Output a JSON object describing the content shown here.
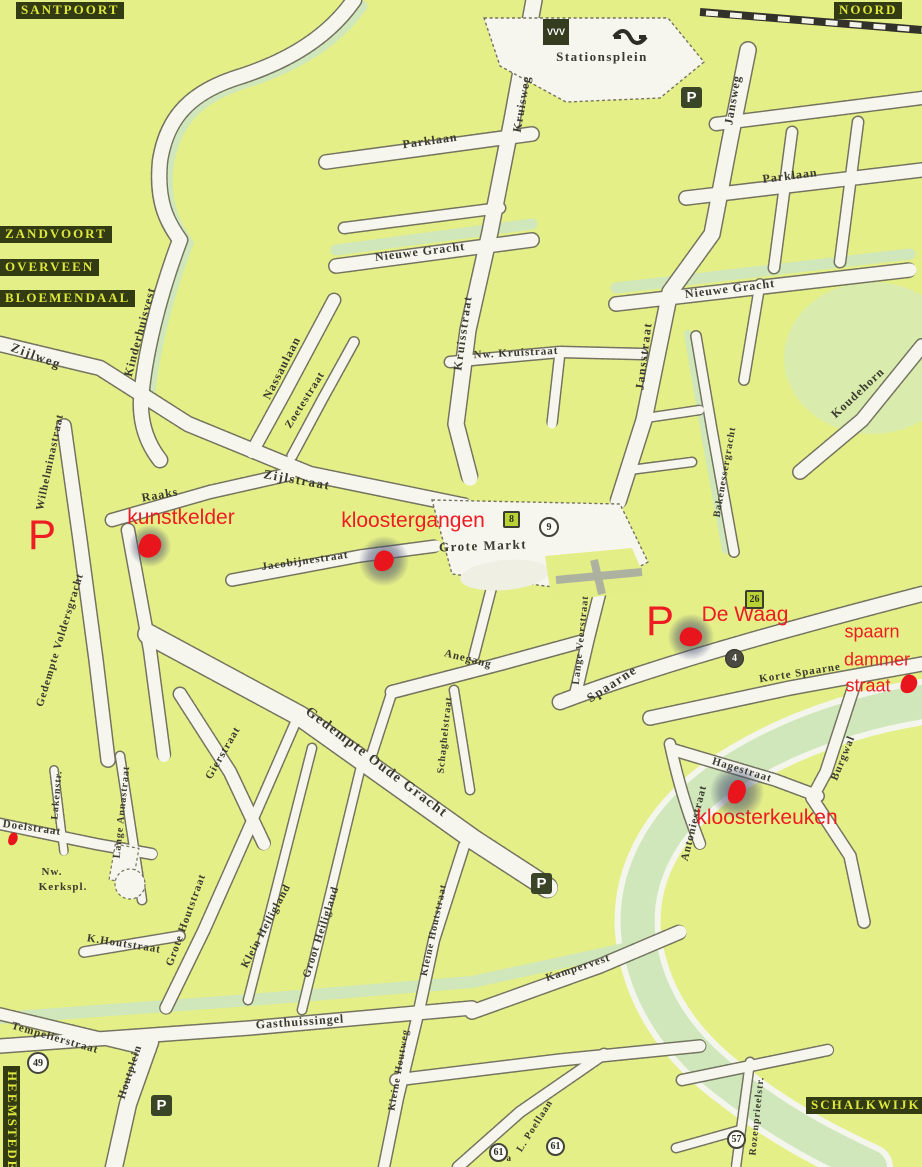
{
  "map": {
    "region_labels": [
      {
        "t": "SANTPOORT",
        "x": 16,
        "y": 2
      },
      {
        "t": "NOORD",
        "x": 834,
        "y": 2
      },
      {
        "t": "ZANDVOORT",
        "x": 0,
        "y": 226
      },
      {
        "t": "OVERVEEN",
        "x": 0,
        "y": 259
      },
      {
        "t": "BLOEMENDAAL",
        "x": 0,
        "y": 290
      },
      {
        "t": "HEEMSTEDE",
        "x": 20,
        "y": 1066,
        "vert": 1
      },
      {
        "t": "SCHALKWIJK",
        "x": 806,
        "y": 1097
      }
    ],
    "street_labels": [
      {
        "t": "Stationsplein",
        "x": 602,
        "y": 57,
        "r": 0,
        "s": 13,
        "b": 1
      },
      {
        "t": "Parklaan",
        "x": 430,
        "y": 141,
        "r": -8,
        "s": 12
      },
      {
        "t": "Parklaan",
        "x": 790,
        "y": 176,
        "r": -7,
        "s": 12
      },
      {
        "t": "Kruisweg",
        "x": 522,
        "y": 104,
        "r": -80,
        "s": 12
      },
      {
        "t": "Jansweg",
        "x": 733,
        "y": 100,
        "r": -80,
        "s": 12
      },
      {
        "t": "Nieuwe Gracht",
        "x": 420,
        "y": 252,
        "r": -7,
        "s": 12
      },
      {
        "t": "Nieuwe Gracht",
        "x": 730,
        "y": 289,
        "r": -7,
        "s": 12
      },
      {
        "t": "Kinderhuisvest",
        "x": 140,
        "y": 332,
        "r": -75,
        "s": 12
      },
      {
        "t": "Zijlweg",
        "x": 36,
        "y": 356,
        "r": 20,
        "s": 13,
        "b": 1
      },
      {
        "t": "Nassaulaan",
        "x": 282,
        "y": 368,
        "r": -63,
        "s": 12
      },
      {
        "t": "Zoetestraat",
        "x": 305,
        "y": 400,
        "r": -58,
        "s": 11
      },
      {
        "t": "Kruisstraat",
        "x": 463,
        "y": 333,
        "r": -82,
        "s": 12,
        "b": 1
      },
      {
        "t": "Nw. Kruistraat",
        "x": 516,
        "y": 353,
        "r": -3,
        "s": 11
      },
      {
        "t": "Jansstraat",
        "x": 644,
        "y": 356,
        "r": -83,
        "s": 12,
        "b": 1
      },
      {
        "t": "Koudehorn",
        "x": 858,
        "y": 393,
        "r": -43,
        "s": 12
      },
      {
        "t": "Bakenessergracht",
        "x": 725,
        "y": 472,
        "r": -80,
        "s": 10
      },
      {
        "t": "Zijlstraat",
        "x": 297,
        "y": 480,
        "r": 10,
        "s": 13,
        "b": 1
      },
      {
        "t": "Raaks",
        "x": 160,
        "y": 495,
        "r": -10,
        "s": 12
      },
      {
        "t": "Wilhelminastraat",
        "x": 50,
        "y": 462,
        "r": -78,
        "s": 11
      },
      {
        "t": "Jacobijnestraat",
        "x": 305,
        "y": 561,
        "r": -8,
        "s": 11
      },
      {
        "t": "Grote Markt",
        "x": 483,
        "y": 546,
        "r": -2,
        "s": 13,
        "b": 1
      },
      {
        "t": "Gedempte Voldersgracht",
        "x": 60,
        "y": 640,
        "r": -73,
        "s": 11
      },
      {
        "t": "Anegang",
        "x": 468,
        "y": 659,
        "r": 14,
        "s": 11
      },
      {
        "t": "Lange Veerstraat",
        "x": 581,
        "y": 640,
        "r": -84,
        "s": 10
      },
      {
        "t": "Spaarne",
        "x": 612,
        "y": 684,
        "r": -33,
        "s": 13,
        "b": 1
      },
      {
        "t": "Korte Spaarne",
        "x": 800,
        "y": 673,
        "r": -9,
        "s": 11
      },
      {
        "t": "Gierstraat",
        "x": 223,
        "y": 753,
        "r": -60,
        "s": 11
      },
      {
        "t": "Gedempte Oude Gracht",
        "x": 376,
        "y": 763,
        "r": 37,
        "s": 14,
        "b": 1
      },
      {
        "t": "Schaghelstraat",
        "x": 445,
        "y": 735,
        "r": -84,
        "s": 10
      },
      {
        "t": "Hagestraat",
        "x": 742,
        "y": 770,
        "r": 17,
        "s": 11
      },
      {
        "t": "Burgwal",
        "x": 843,
        "y": 758,
        "r": -68,
        "s": 11
      },
      {
        "t": "Antoniestraat",
        "x": 694,
        "y": 823,
        "r": -76,
        "s": 11
      },
      {
        "t": "Doelstraat",
        "x": 32,
        "y": 828,
        "r": 8,
        "s": 11
      },
      {
        "t": "Lakenstr.",
        "x": 57,
        "y": 795,
        "r": -85,
        "s": 10
      },
      {
        "t": "Lange Annastraat",
        "x": 122,
        "y": 812,
        "r": -84,
        "s": 10
      },
      {
        "t": "Nw.",
        "x": 52,
        "y": 872,
        "r": 0,
        "s": 11
      },
      {
        "t": "Kerkspl.",
        "x": 63,
        "y": 887,
        "r": 0,
        "s": 11
      },
      {
        "t": "K.Houtstraat",
        "x": 124,
        "y": 944,
        "r": 9,
        "s": 11
      },
      {
        "t": "Grote Houtstraat",
        "x": 186,
        "y": 920,
        "r": -70,
        "s": 11
      },
      {
        "t": "Klein Heiligland",
        "x": 266,
        "y": 926,
        "r": -62,
        "s": 11
      },
      {
        "t": "Groot Heiligland",
        "x": 321,
        "y": 932,
        "r": -72,
        "s": 11
      },
      {
        "t": "Kleine Houtstraat",
        "x": 434,
        "y": 930,
        "r": -78,
        "s": 10
      },
      {
        "t": "Kampervest",
        "x": 578,
        "y": 968,
        "r": -18,
        "s": 11
      },
      {
        "t": "Gasthuissingel",
        "x": 300,
        "y": 1022,
        "r": -4,
        "s": 12
      },
      {
        "t": "Tempelierstraat",
        "x": 55,
        "y": 1038,
        "r": 16,
        "s": 11
      },
      {
        "t": "Houtplein",
        "x": 130,
        "y": 1072,
        "r": -72,
        "s": 11
      },
      {
        "t": "Kleine Houtweg",
        "x": 399,
        "y": 1070,
        "r": -80,
        "s": 10
      },
      {
        "t": "L. Poellaan",
        "x": 535,
        "y": 1126,
        "r": -58,
        "s": 10
      },
      {
        "t": "Rozenprieelstr.",
        "x": 757,
        "y": 1116,
        "r": -84,
        "s": 10
      }
    ],
    "poi_labels": [
      {
        "t": "kunstkelder",
        "x": 181,
        "y": 518,
        "s": 21
      },
      {
        "t": "kloostergangen",
        "x": 413,
        "y": 521,
        "s": 21
      },
      {
        "t": "De Waag",
        "x": 745,
        "y": 615,
        "s": 21
      },
      {
        "t": "kloosterkeuken",
        "x": 767,
        "y": 818,
        "s": 21
      },
      {
        "t": "spaarn",
        "x": 872,
        "y": 632,
        "s": 18
      },
      {
        "t": "dammer",
        "x": 877,
        "y": 660,
        "s": 18
      },
      {
        "t": "straat",
        "x": 868,
        "y": 686,
        "s": 18
      }
    ],
    "markers": [
      {
        "x": 150,
        "y": 546,
        "halo": 42,
        "w": 22,
        "h": 24
      },
      {
        "x": 384,
        "y": 561,
        "halo": 50,
        "w": 19,
        "h": 21
      },
      {
        "x": 691,
        "y": 637,
        "halo": 46,
        "w": 22,
        "h": 19
      },
      {
        "x": 737,
        "y": 792,
        "halo": 54,
        "w": 17,
        "h": 24
      },
      {
        "x": 909,
        "y": 684,
        "halo": 0,
        "w": 16,
        "h": 19
      },
      {
        "x": 13,
        "y": 839,
        "halo": 0,
        "w": 9,
        "h": 13
      }
    ],
    "parking_glyph": "P",
    "parking_icons": [
      {
        "x": 681,
        "y": 87
      },
      {
        "x": 531,
        "y": 873
      },
      {
        "x": 151,
        "y": 1095
      }
    ],
    "red_p_marks": [
      {
        "x": 28,
        "y": 514
      },
      {
        "x": 646,
        "y": 600
      }
    ],
    "badges": [
      {
        "shape": "gsq",
        "t": "8",
        "x": 503,
        "y": 511,
        "size": 17
      },
      {
        "shape": "circle",
        "t": "9",
        "x": 539,
        "y": 517,
        "size": 20
      },
      {
        "shape": "gsq",
        "t": "26",
        "x": 745,
        "y": 590,
        "size": 19
      },
      {
        "shape": "dcirc",
        "t": "4",
        "x": 725,
        "y": 649,
        "size": 19
      },
      {
        "shape": "circle",
        "t": "49",
        "x": 27,
        "y": 1052,
        "size": 22
      },
      {
        "shape": "circle",
        "t": "61",
        "x": 489,
        "y": 1143,
        "size": 19,
        "sfx": "a"
      },
      {
        "shape": "circle",
        "t": "61",
        "x": 546,
        "y": 1137,
        "size": 19
      },
      {
        "shape": "circle",
        "t": "57",
        "x": 727,
        "y": 1130,
        "size": 19
      }
    ],
    "station": {
      "vvv": "VVV"
    }
  }
}
